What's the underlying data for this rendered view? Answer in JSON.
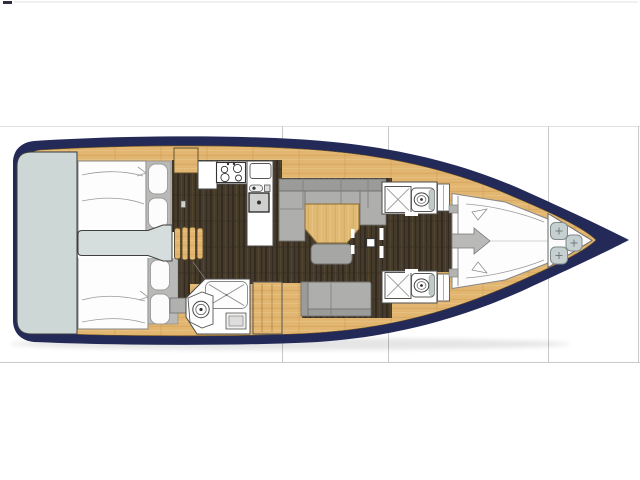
{
  "image": {
    "kind": "yacht-interior-floor-plan",
    "description": "Top-down deck/interior layout drawing of a sailing yacht shown on a white page with faint table grid lines. No text is rendered in the image.",
    "orientation": "bow pointing right, stern at left"
  },
  "colors": {
    "background": "#ffffff",
    "grid_line": "#e0e0e0",
    "grid_line_dark": "#c9c9c9",
    "hull_navy": "#242a57",
    "deck_wood": "#e2b670",
    "wood_grain": "#c08d43",
    "table_wood": "#e0ba74",
    "floor_dark": "#453a2b",
    "transom_gray": "#ccd7d6",
    "upholstery_gray": "#b9bab8",
    "sofa_gray": "#aeaeac",
    "hatch_gray": "#c6d0d1"
  },
  "regions": [
    {
      "name": "swim-platform-transom"
    },
    {
      "name": "aft-cabin-port-double-berth"
    },
    {
      "name": "aft-cabin-starboard-double-berth"
    },
    {
      "name": "companionway-steps"
    },
    {
      "name": "engine-box"
    },
    {
      "name": "galley-with-stove-and-sink"
    },
    {
      "name": "aft-head-with-shower-and-toilet"
    },
    {
      "name": "saloon-u-sofa-with-table"
    },
    {
      "name": "saloon-bench-sofa"
    },
    {
      "name": "mast-post"
    },
    {
      "name": "forward-head-port"
    },
    {
      "name": "forward-head-starboard"
    },
    {
      "name": "forward-owner-cabin-v-berth"
    },
    {
      "name": "bow-anchor-locker"
    }
  ],
  "counts": {
    "cabins": 3,
    "heads": 3,
    "shower_trays": 3,
    "toilets": 3,
    "bow_deck_hatches": 3,
    "companionway_steps": 4
  }
}
